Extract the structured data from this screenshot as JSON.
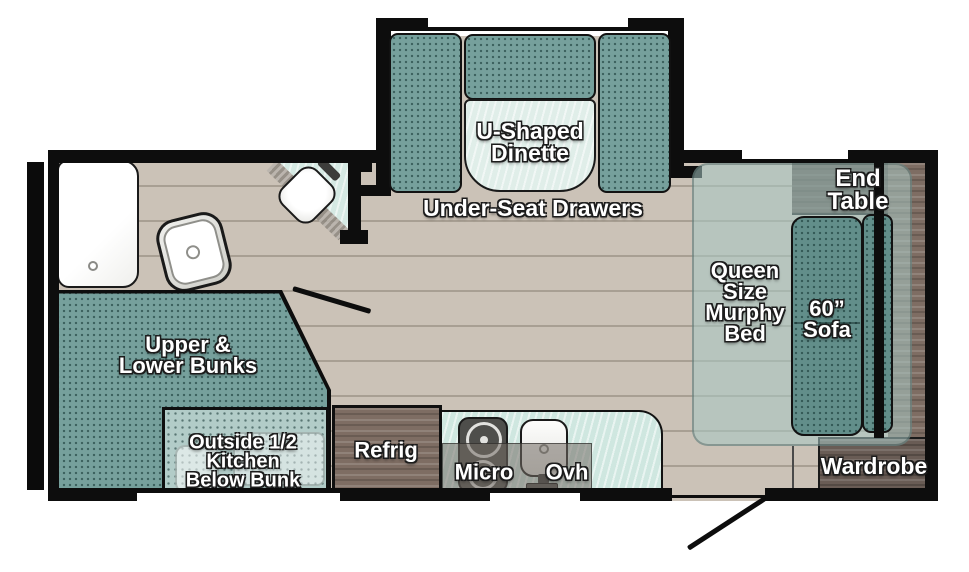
{
  "labels": {
    "dinette": [
      "U-Shaped",
      "Dinette"
    ],
    "under_seat_drawers": "Under-Seat Drawers",
    "end_table": [
      "End",
      "Table"
    ],
    "murphy_bed": [
      "Queen",
      "Size",
      "Murphy",
      "Bed"
    ],
    "sofa": [
      "60”",
      "Sofa"
    ],
    "wardrobe": "Wardrobe",
    "bunks": [
      "Upper &",
      "Lower Bunks"
    ],
    "outside_kitchen": [
      "Outside 1/2",
      "Kitchen",
      "Below Bunk"
    ],
    "refrig": "Refrig",
    "micro": "Micro",
    "ovh": "Ovh"
  },
  "colors": {
    "wall": "#0d0d0d",
    "floor": "#cbc2b7",
    "floor_line": "#a89f93",
    "cushion": "#76a09c",
    "cushion_dark": "#628e8a",
    "cushion_light": "#b2ccc8",
    "counter": "#cfe7e0",
    "table_top": "#e0eee9",
    "wood": "#7e6d63",
    "wood_dark": "#695c55",
    "murphy_overlay": "rgba(168,200,196,0.55)",
    "shade_overlay": "rgba(45,45,42,0.4)",
    "cabinet_overlay": "rgba(115,108,100,0.55)"
  },
  "icons": [
    "shower",
    "toilet",
    "corner-sink",
    "stove-burners",
    "kitchen-sink",
    "entry-door-swing",
    "bathroom-door-swing"
  ]
}
